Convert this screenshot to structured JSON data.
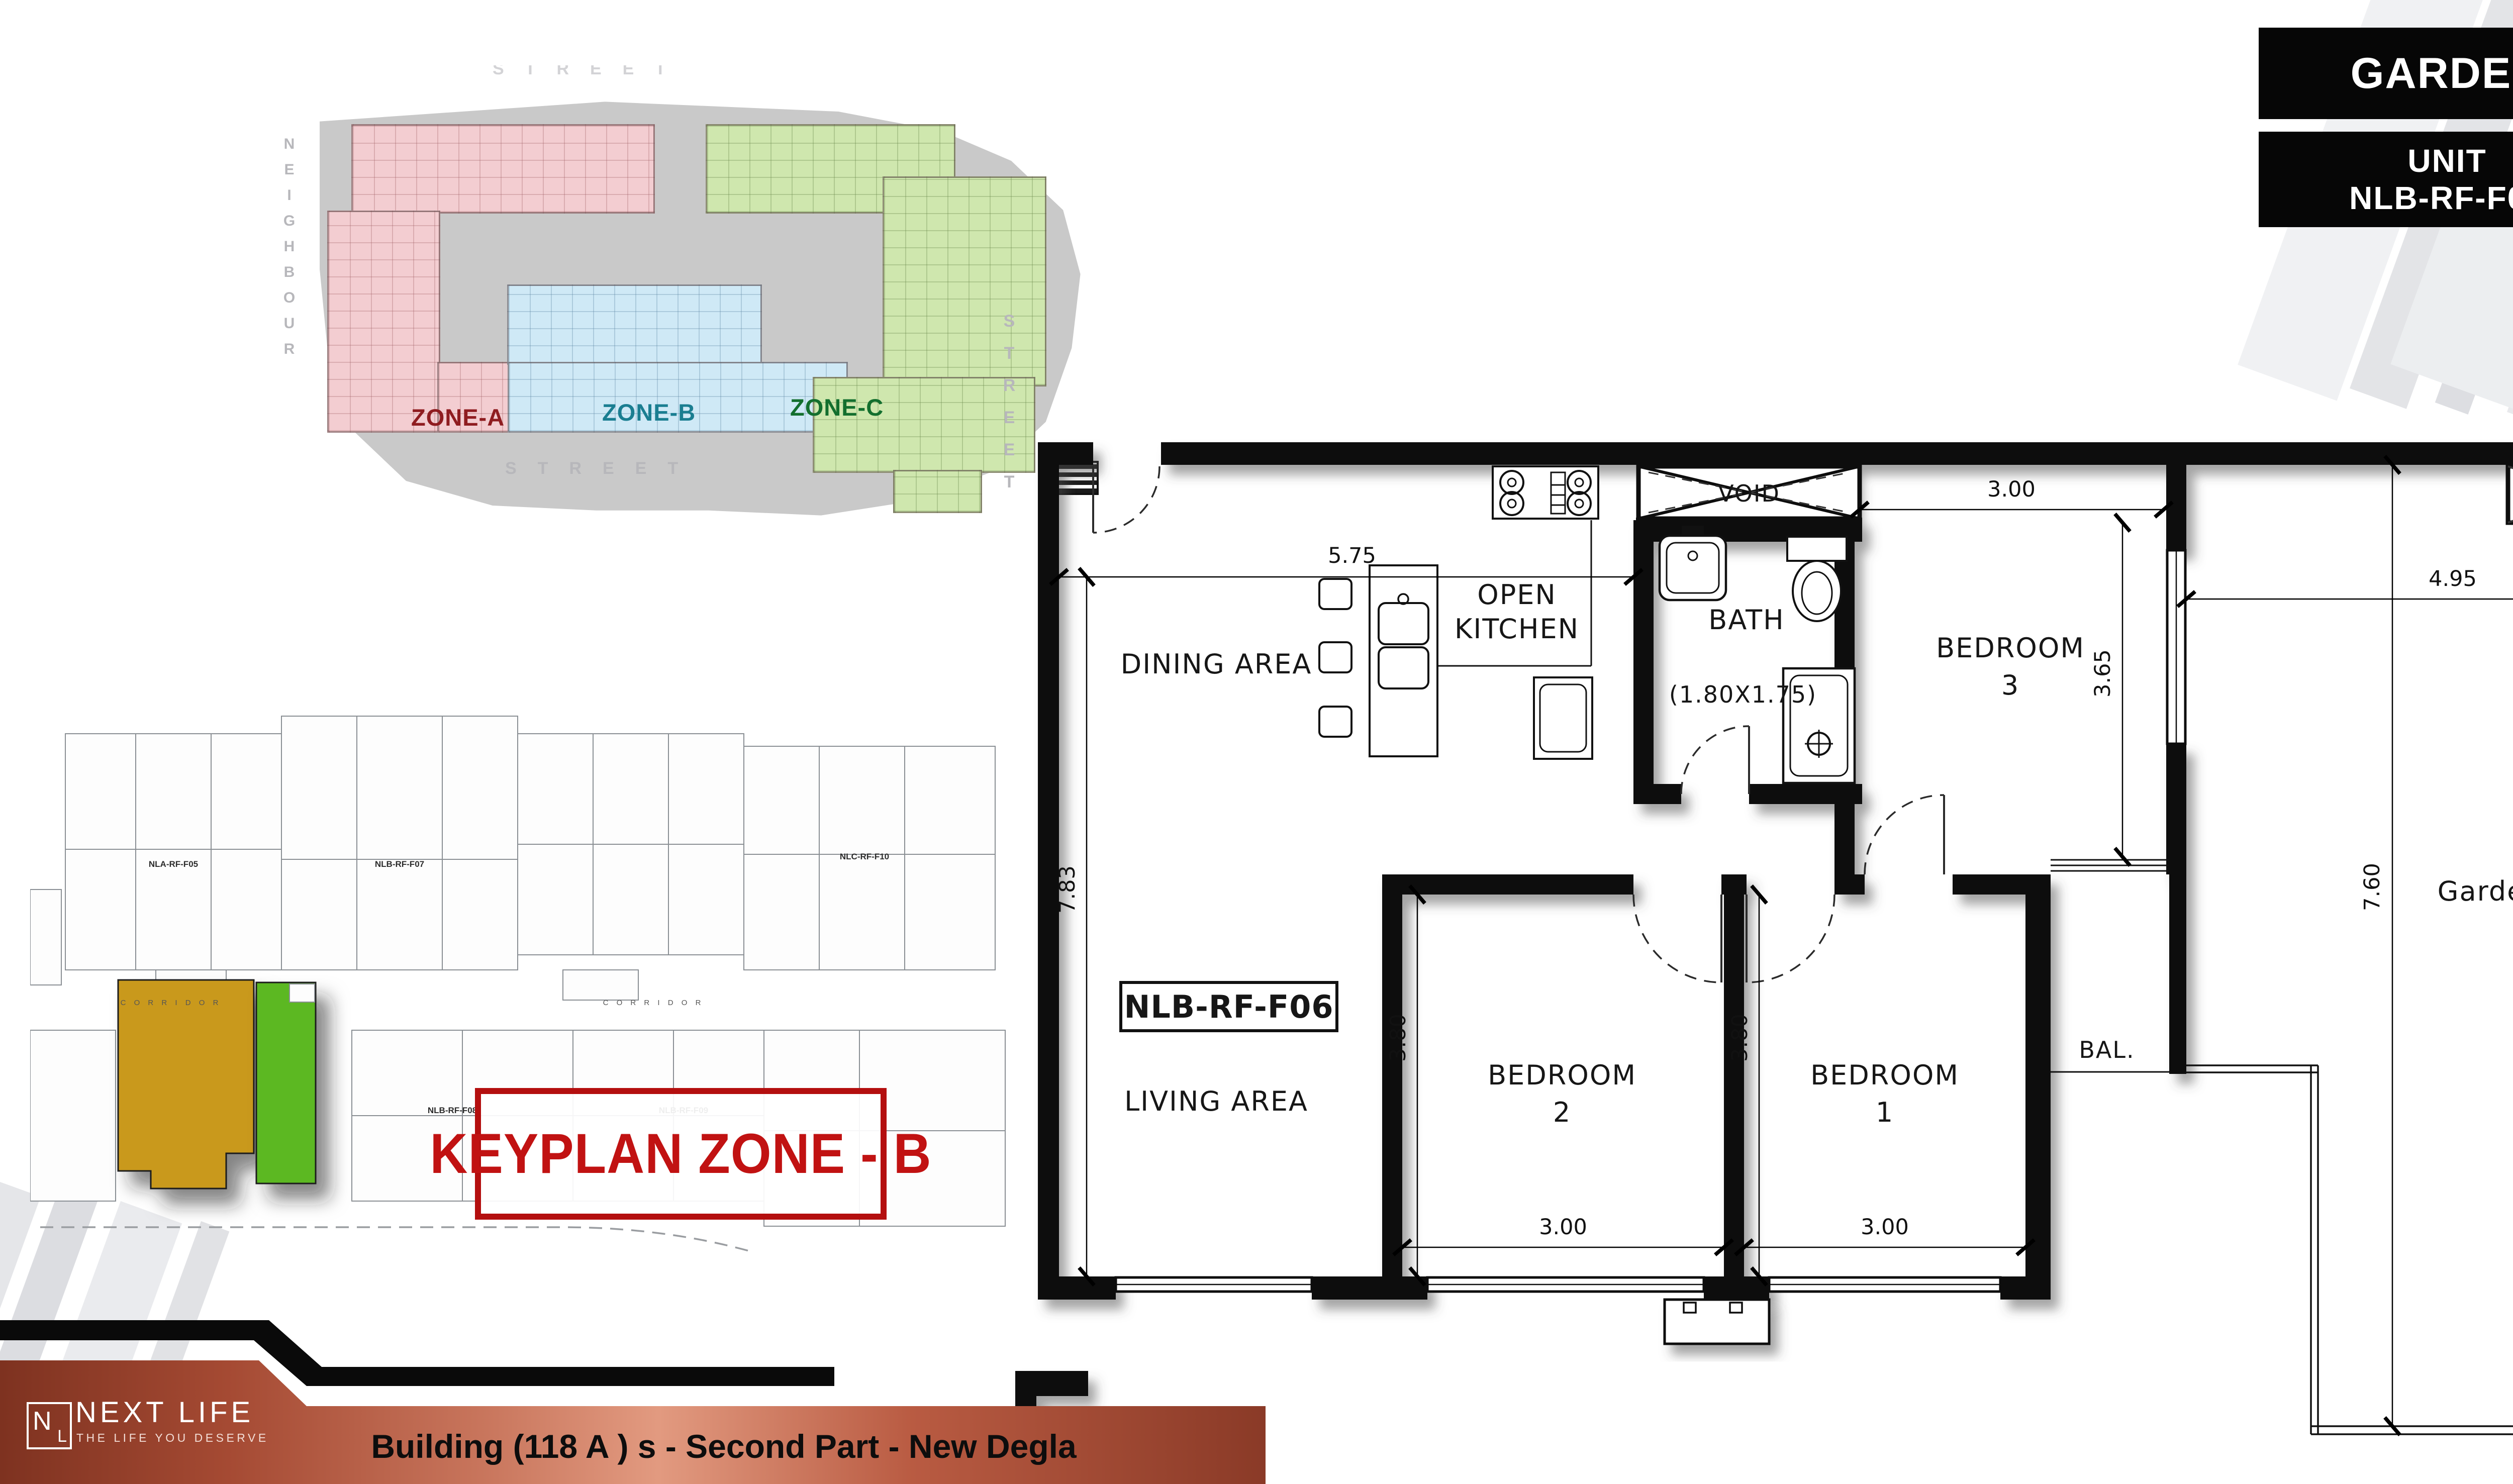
{
  "badges": {
    "garden": {
      "label": "GARDEN",
      "value": "33.45",
      "unit": "m",
      "sup": "2"
    },
    "unit": {
      "label1": "UNIT",
      "label2": "NLB-RF-F06",
      "value": "116.25",
      "unit": "m",
      "sup": "2"
    }
  },
  "stats": [
    {
      "icon": "sofa-lamp",
      "count": "1"
    },
    {
      "icon": "dining-table",
      "count": "1"
    },
    {
      "icon": "bed",
      "count": "3"
    },
    {
      "icon": "bathtub",
      "count": "1"
    }
  ],
  "zone_map": {
    "zone_a": "ZONE-A",
    "zone_b": "ZONE-B",
    "zone_c": "ZONE-C",
    "street_top": "STREET",
    "street_right": "STREET",
    "street_bottom": "STREET",
    "neighbour": "NEIGHBOUR"
  },
  "keyplan": {
    "title": "KEYPLAN ZONE - B",
    "corridor": "C O R R I D O R",
    "units": {
      "u1": "NLA-RF-F05",
      "u2": "NLB-RF-F07",
      "u3": "NLC-RF-F10",
      "u4": "NLB-RF-F08",
      "u5": "NLB-RF-F09"
    }
  },
  "plan": {
    "unit_code": "NLB-RF-F06",
    "rooms": {
      "dining": "DINING AREA",
      "kitchen1": "OPEN",
      "kitchen2": "KITCHEN",
      "bath": "BATH",
      "bath_dim": "(1.80X1.75)",
      "void1": "VOID",
      "void2": "VOID",
      "bed3a": "BEDROOM",
      "bed3b": "3",
      "living": "LIVING AREA",
      "bed2a": "BEDROOM",
      "bed2b": "2",
      "bed1a": "BEDROOM",
      "bed1b": "1",
      "bal": "BAL.",
      "garden": "Garden ROOF"
    },
    "dims": {
      "d575": "5.75",
      "d783": "7.83",
      "d300_bed3": "3.00",
      "d365": "3.65",
      "d495": "4.95",
      "d760": "7.60",
      "d380_bed2": "3.80",
      "d300_bed2": "3.00",
      "d380_bed1": "3.80",
      "d300_bed1": "3.00"
    }
  },
  "footer": {
    "brand": "NEXT LIFE",
    "tagline": "THE LIFE YOU DESERVE",
    "title": "Building (118 A ) s - Second Part - New Degla",
    "mono1": "N",
    "mono2": "L"
  }
}
